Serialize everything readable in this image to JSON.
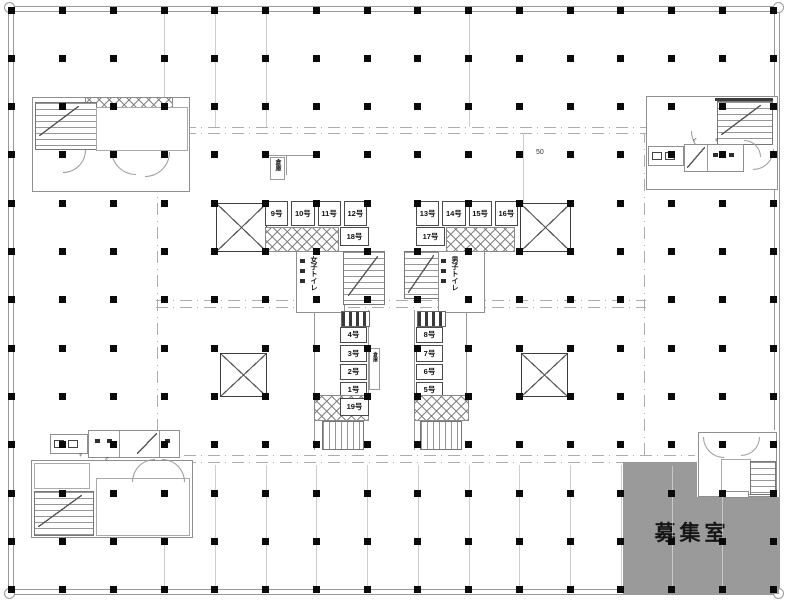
{
  "plan": {
    "vacancy_label": "募集室",
    "dimension_label": "50",
    "shaft_label": "倉庫",
    "stack_storage_label": "倉庫",
    "toilet_left_core": "女子トイレ",
    "toilet_right_core": "男子トイレ",
    "male_symbol": "♂",
    "female_symbol": "♀",
    "rooms_upper_left": [
      "9号",
      "10号",
      "11号",
      "12号"
    ],
    "room_upper_left_sub": "18号",
    "rooms_upper_right": [
      "13号",
      "14号",
      "15号",
      "16号"
    ],
    "room_upper_right_sub": "17号",
    "rooms_lower_left": [
      "4号",
      "3号",
      "2号",
      "1号"
    ],
    "room_lower_left_sub": "19号",
    "rooms_lower_right": [
      "8号",
      "7号",
      "6号",
      "5号"
    ],
    "colors": {
      "vacancy_fill": "#9a9a9a",
      "column": "#0a0a0a",
      "wall": "#9a9a9a"
    }
  }
}
